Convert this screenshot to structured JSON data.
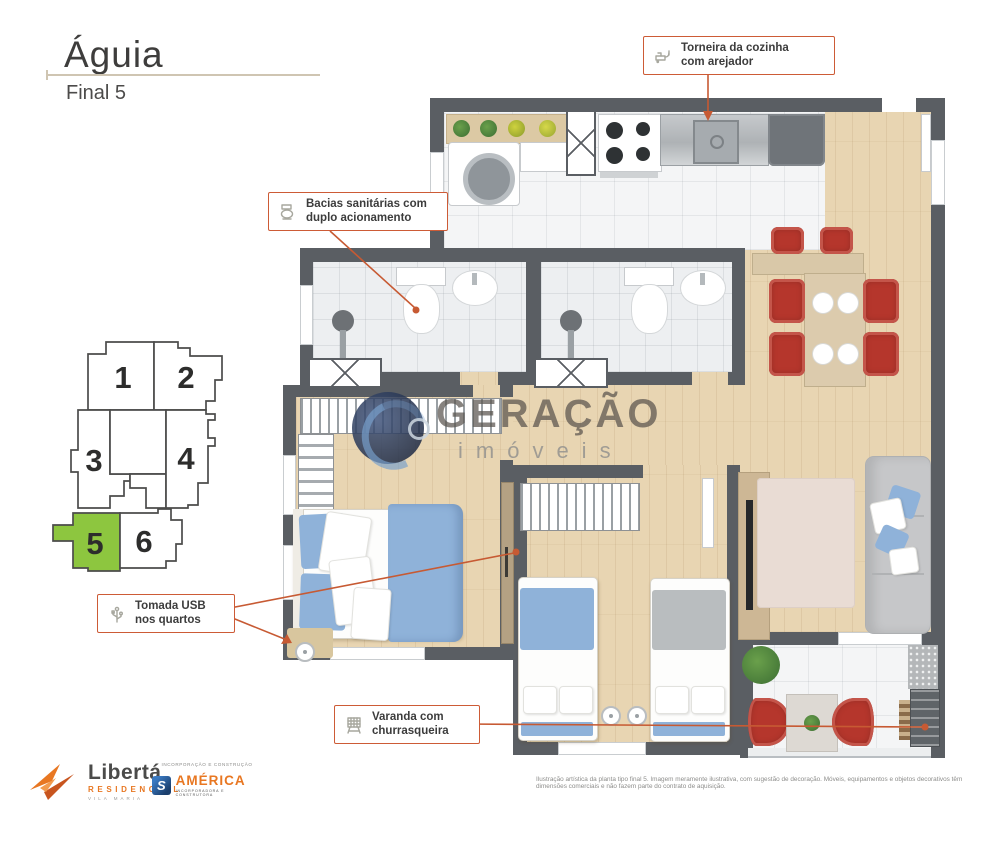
{
  "header": {
    "title": "Águia",
    "subtitle": "Final 5"
  },
  "callouts": {
    "faucet": {
      "line1": "Torneira da cozinha",
      "line2": "com arejador"
    },
    "toilet": {
      "line1": "Bacias sanitárias com",
      "line2": "duplo acionamento"
    },
    "usb": {
      "line1": "Tomada USB",
      "line2": "nos quartos"
    },
    "grill": {
      "line1": "Varanda com",
      "line2": "churrasqueira"
    }
  },
  "keyplan": {
    "highlighted_unit": "5",
    "highlight_color": "#8dc63f",
    "units": [
      {
        "number": "1"
      },
      {
        "number": "2"
      },
      {
        "number": "3"
      },
      {
        "number": "4"
      },
      {
        "number": "5"
      },
      {
        "number": "6"
      }
    ]
  },
  "watermark": {
    "brand": "GERAÇÃO",
    "tagline": "imóveis"
  },
  "footer": {
    "liberta": {
      "name": "Libertá",
      "line2": "RESIDENCIAL",
      "line3": "VILA MARIA"
    },
    "america": {
      "header": "INCORPORAÇÃO E CONSTRUÇÃO",
      "mark": "S",
      "name": "AMÉRICA",
      "sub": "INCORPORADORA E CONSTRUTORA"
    },
    "disclaimer": "Ilustração artística da planta tipo final 5. Imagem meramente ilustrativa, com sugestão de decoração. Móveis, equipamentos e objetos decorativos têm dimensões comerciais e não fazem parte do contrato de aquisição."
  },
  "colors": {
    "accent": "#cd5b36",
    "highlight": "#8dc63f",
    "wall": "#5a5e63",
    "bedding_blue": "#8fb2d9",
    "chair_red": "#b5362c"
  }
}
